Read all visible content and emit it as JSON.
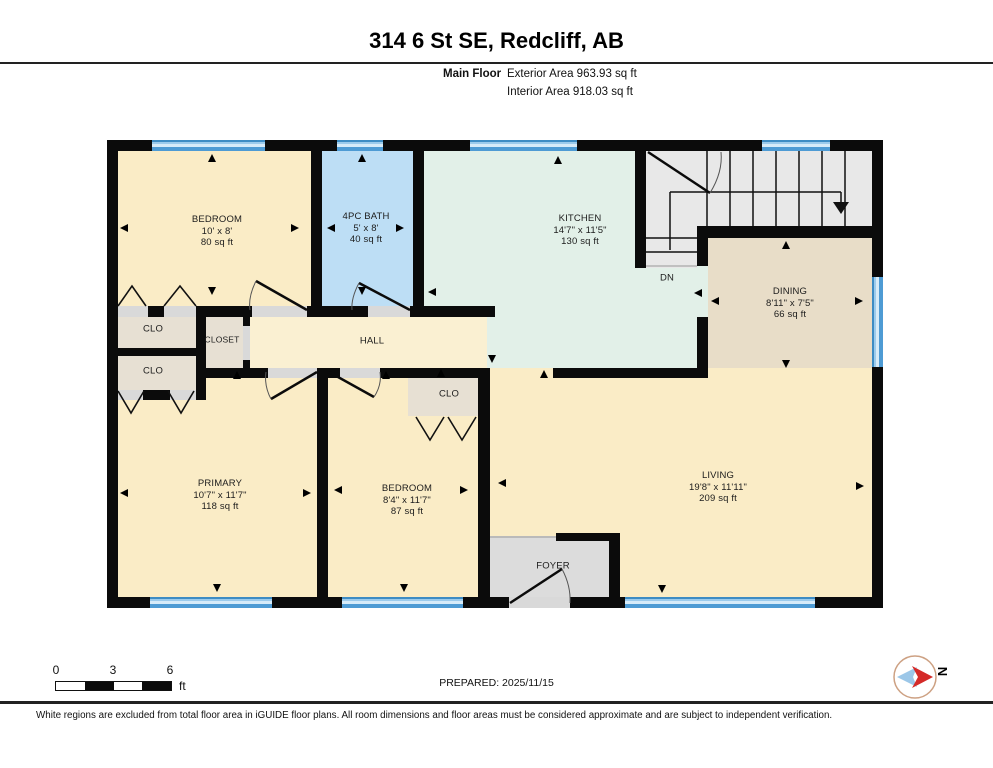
{
  "header": {
    "title": "314 6 St SE, Redcliff, AB",
    "floor_label": "Main Floor",
    "exterior_area": "Exterior Area 963.93 sq ft",
    "interior_area": "Interior Area 918.03 sq ft"
  },
  "rooms": {
    "bedroom_top": {
      "name": "BEDROOM",
      "dims": "10' x 8'",
      "area": "80 sq ft"
    },
    "bath": {
      "name": "4PC BATH",
      "dims": "5' x 8'",
      "area": "40 sq ft"
    },
    "kitchen": {
      "name": "KITCHEN",
      "dims": "14'7\" x 11'5\"",
      "area": "130 sq ft"
    },
    "dining": {
      "name": "DINING",
      "dims": "8'11\" x 7'5\"",
      "area": "66 sq ft"
    },
    "primary": {
      "name": "PRIMARY",
      "dims": "10'7\" x 11'7\"",
      "area": "118 sq ft"
    },
    "bedroom_bottom": {
      "name": "BEDROOM",
      "dims": "8'4\" x 11'7\"",
      "area": "87 sq ft"
    },
    "living": {
      "name": "LIVING",
      "dims": "19'8\" x 11'11\"",
      "area": "209 sq ft"
    },
    "hall": {
      "name": "HALL"
    },
    "closet": {
      "name": "CLOSET"
    },
    "clo_upper": {
      "name": "CLO"
    },
    "clo_lower": {
      "name": "CLO"
    },
    "clo_bedroom": {
      "name": "CLO"
    },
    "foyer": {
      "name": "FOYER"
    },
    "stairs": {
      "down_label": "DN"
    }
  },
  "footer": {
    "scale": {
      "n0": "0",
      "n3": "3",
      "n6": "6",
      "unit": "ft"
    },
    "prepared": "PREPARED: 2025/11/15",
    "disclaimer": "White regions are excluded from total floor area in iGUIDE floor plans. All room dimensions and floor areas must be considered approximate and are subject to independent verification."
  },
  "compass": {
    "north_label": "N"
  },
  "colors": {
    "room_cream": "#FAECC6",
    "bath_blue": "#BDDEF5",
    "kitchen_green": "#E2F0E8",
    "dining_tan": "#E8DDC8",
    "closet_taupe": "#E7E0D3",
    "stairs_gray": "#E8E8E8",
    "foyer_gray": "#DCDCDC",
    "window_blue": "#9CCBEC",
    "wall_black": "#0B0B0B"
  }
}
